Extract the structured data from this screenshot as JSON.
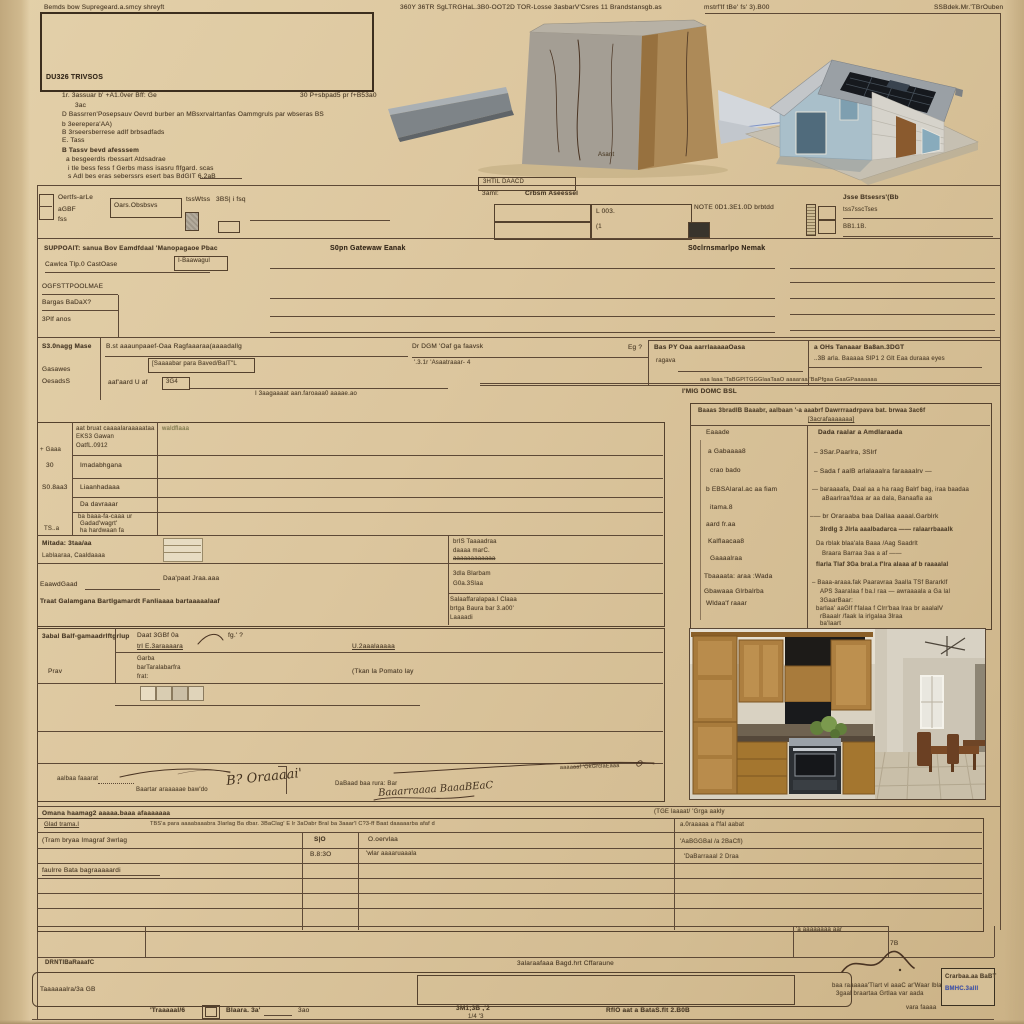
{
  "colors": {
    "paper": "#dcc69e",
    "ink": "#35291b",
    "line": "#5d4936",
    "stamp_blue": "#3f55b5"
  },
  "top_header": {
    "left": "Bemds bow Supregeard.a.smcy shreyft",
    "center": "360Y 36TR SgLTRGHaL.3B0-OOT2D TOR-Losse 3asbarV'Csres 11 Brandstansgb.as",
    "right": "mstrf'lf tBe' fs' 3).B00",
    "corner": "SSBdek.Mr.'TBrOuben"
  },
  "logo_box": {
    "label": "DU326 TRIVSOS"
  },
  "instructions": {
    "items": [
      "1r. 3assuar b' +A1.0ver Bff: Ge",
      "30 P+sbpad5 pr f+B53a0",
      "3ac",
      "D  Bassrren'Posepsauv Oevrd burber an MBsxrvalrtanfas Oammgruls par wbseras BS",
      "b  3eerepera'AA)",
      "B  3rseersberrese adlf brbsadfads",
      "E. Tass",
      "B  Tassv bevd afesssem",
      "a  besgeerdls rbessart    Atdsadrae",
      "i   tle bess fess f Gerbs mass isasru flfgard. scas",
      "s  Adl bes eras seberssrs esert bas BdGIT 6.2aB"
    ]
  },
  "photos": {
    "box_caption": "Asant",
    "sat_label": "3HTIL DAACD"
  },
  "fields_row": {
    "cb_label1": "Oertfs-arLe",
    "cb_label2": "aGBF",
    "cb_label3": "fss",
    "box1": "Oars.Obsbsvs",
    "mid_label": "tssWtss",
    "mid_box": "3BS| i fsq",
    "center_label1": "3aml:",
    "center_label2": "Crbsm Aseessel",
    "cell_l003": "L 003.",
    "cell_sub": "(1",
    "note": "NOTE 0D1.3E1.0D brbtdd",
    "right_header": "Jsse Btsesrs'(Bb",
    "right_line1": "tss7sscTses",
    "right_line2": "BB1.1B."
  },
  "band1": {
    "h_left": "SUPPOAIT: sanua Bov Eamdfdaal 'Manopagaoe Pbac",
    "h_mid": "S0pn Gatewaw Eanak",
    "h_mid2": "S0clrnsmarlpo Nemak",
    "f1": "Cawlca Tlp.0 CastOase",
    "f1b": "I-Baawagul",
    "f2": "OGFSTTPOOLMAE",
    "f3": "Bargas BaDaX?",
    "f4": "3Plf anos"
  },
  "signage": {
    "label": "S3.0nagg Mase",
    "l2": "Gasawes",
    "l3": "OesadsS",
    "line1": "B.st aaaunpaaef-Oaa Ragfaaaraa(aaaadallg",
    "line2": "[Saaaabar para Baved/BalT\"L",
    "line3": "aaf'aard  U af",
    "box_364": "3G4",
    "line4": "I 3aagaaaat    aan.faroaaa0 aaaae.ao",
    "r1": "Dr DGM 'Oaf ga faavsk",
    "r1b": "'.3.1r 'Asaatraaar- 4",
    "eg": "Eg ?",
    "r2": "Bas PY Oaa aarrlaaaaaOasa",
    "r2b": "ragava",
    "r3": "a OHs Tanaaar Ba8an.3DGT",
    "r3b": "..3B arla. Baaaaa SlP1 2 Glt Eaa duraaa eyes",
    "tiny_rule": "aaa laaa 'TaBGPlTGGGlaaTaaO aaaaraa 'BaPfgaa GaaGPaaaaaaa",
    "bold": "I'MIG DOMC BSL"
  },
  "right_panel": {
    "header1": "Baaas 3bradlB  Baaabr, aalbaan  '-a aaabrf  Dawrrraadrpava bat. brwaa 3ac6f",
    "header2": "[3acrafaaaaaaa]",
    "left_items": [
      "Eaaade",
      "a Gabaaaa8",
      "crao bado",
      "b EBSAlaral.ac aa fiam",
      "itama.8",
      "aard fr.aa",
      "Kalflaacaa8",
      "Gaaaalraa",
      "Tbaaaata: araa :Wada",
      "Gbawaaa Glrbalrba",
      "Wldaa'f raaar"
    ],
    "right_header": "Dada raalar a Amdlaraada",
    "right_lines": [
      "–  3Sar.Paarlra, 3Slrf",
      "–  Sada f aalB arlalaaalra faraaaalrv —",
      "—  baraaaafa, Daal aa a ha raag Balrf bag, iraa baadaa",
      "aBaarlraa'fdaa ar aa dala, Banaafla aa",
      "–— br Oraraaba baa Dallaa aaaal.Garblrk",
      "3lrdlg 3  Jlrla aaalbadarca ——  ralaarrbaaalk",
      "Da rblak blaa'ala Baaa /Aag Saadrlt",
      "Braara  Barraa 3aa a af ——",
      "flarla Tlaf 3Ga bral.a f'lra alaaa af b raaaalal",
      "–  Baaa-araaa.fak Paaravraa 3aalla TSf Bararklf",
      "APS 3aaralaa f ba.l raa  — awraaaala a Ga lal",
      "3GaarBaar:",
      "barlaa' aaGlf f'falaa f  Clrr'baa lraa  br aaalalV",
      "rBaaalr /faak la  irlgalaa 3lraa",
      "ba'laart"
    ]
  },
  "main_table": {
    "c2r1a": "aat bruat caaaalaraaaaataa",
    "c2r1b": "EKS3 Gawan",
    "c2r1c": "OatfL.0912",
    "green": "waldflaaa",
    "c1r1": "+ Gaaa",
    "c1r2": "30",
    "c2r2": "Imadabhgana",
    "c1r3": "S0.8aa3",
    "c2r3": "Liaanhadaaa",
    "c2r4": "Da davraaar",
    "c2r5a": "ba baaa-fa-caaa ur",
    "c2r5b": "Gadad'wagrt'",
    "c2r5c": "ha hardwaan fa",
    "c1r5": "TS..a",
    "r6a": "Mitada:  3taa/aa",
    "r6b": "Lablaaraa,   Caaldaaaa",
    "r6r1": "brIS Taaaadraa",
    "r6r2": "daaaa marC.",
    "r6r3": "aaaaaaaaaaaa",
    "r7l": "EaawdGaad",
    "r7m": "Daa'paat Jraa.aaa",
    "r7r1": "3dla Blarbam",
    "r7r2": "G0a.3Slaa",
    "r8": "Traat Galamgana Bartlgamardt Fanliaaaa bartaaaaalaaf",
    "r8r1": "Salaaffaralapaa.l Claaa",
    "r8r2": "brtga Baura bar 3.a00'",
    "r8r3": "Laaaadi"
  },
  "mid_section": {
    "title": "3abal Balf-gamaadrlftgrlup",
    "f1a": "Daat 3GBf 0a",
    "f1b": "trl E.3araaaara",
    "q": "fg.' ?",
    "r1": "U.2aaalaaaaa",
    "row2l": "Prav",
    "row2a": "Garba",
    "row2b": "barTaralabarfra",
    "row2c": "frat:",
    "row2r": "(Tkan la Pomato lay"
  },
  "signatures": {
    "s1_label": "aalbaa faaarat",
    "s1_sub": "Baartar araaaaae baw'do",
    "s1_sig": "B? Oraaaai'",
    "s2_label": "DaBaad baa rura: Bar",
    "s2_sig": "Baaarraaaa BaaaBEaC",
    "s2_tiny": "aaaaaaf 'OkGrclaEaaa"
  },
  "bottom_table": {
    "title": "Omana haamag2 aaaaa.baaa afaaaaaaa",
    "side_note": "(TGE laaaat/ 'Grga aakly",
    "header_left": "Glad trama.l",
    "header_tiny": "TBS'a para aaaabaaabra 3larlag Ba dbar. 3BaClag' E lr 3aOabr  Bral ba 3aaar'l C?3-ff  Baat daaaaarba afaf d",
    "row1": "(Tram bryaa Imagraf 3wrlag",
    "col_a": "S|O",
    "col_a2": "B.8:3O",
    "col_b": "O.oervlaa",
    "col_b2": "'wlar aaaaruaaala",
    "row2": "faulrre Bata bagraaaaardi",
    "right_labels": [
      "a.0raaaaa a f'fal aabat",
      "'AaBGGBal /a 2BaCfl)",
      "'DaBarraaal 2 Draa"
    ]
  },
  "declare": {
    "label": "DRNTlBaRaaafC",
    "tiny": "'a aaaaaaaa aar",
    "zb": "7B"
  },
  "footer_box": {
    "above": "3alaraafaaa Bagd.hrt Cffaraune",
    "inner": "Taaaaaalra/3a GB",
    "note1": "baa raaaaaa'Tlart vl aaaC ar'Waar lbla",
    "note2": "3gaal braartaa Grtlaa var aada",
    "note3": "vara faaaa",
    "stamp1": "Crarbaa.aa BaBT",
    "stamp2": "BMHC.3alll",
    "sig": "2dl. a"
  },
  "footer": {
    "f1": "'Traaaaal/6",
    "f2": "Blaara. 3a'",
    "f2b": "3ao",
    "f3": "3M1;3B  ,'2",
    "f3b": "1/4 '3",
    "f4": "RflO aat a BataS.flt   2.B0B"
  }
}
